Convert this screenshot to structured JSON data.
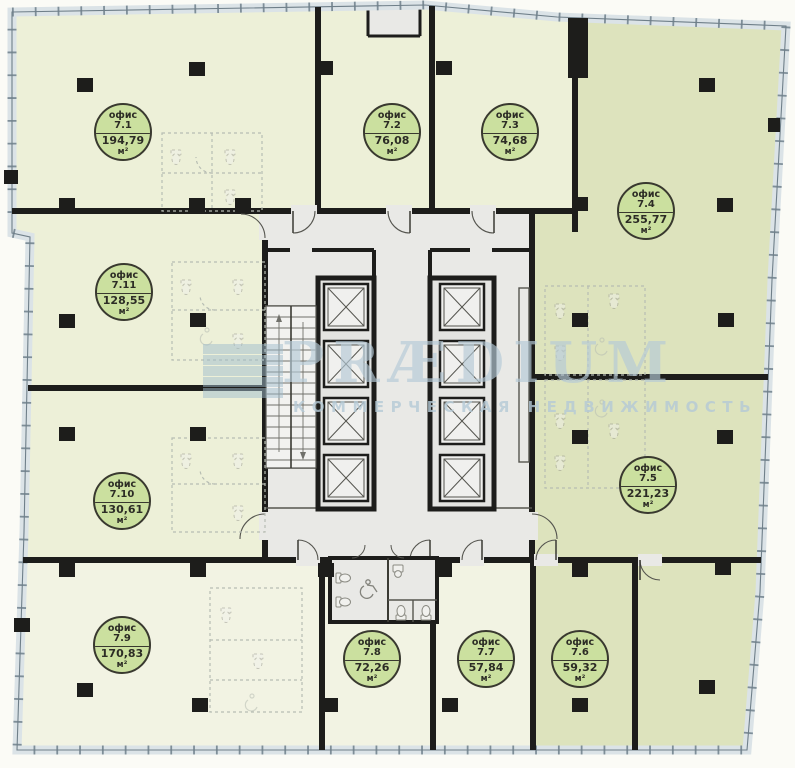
{
  "floor_plan": {
    "watermark": {
      "brand": "PRÆDIUM",
      "tagline": "КОММЕРЧЕСКАЯ НЕДВИЖИМОСТЬ"
    },
    "unit_label": "офис",
    "area_unit": "м²",
    "offices": [
      {
        "id": "7.1",
        "area": "194,79"
      },
      {
        "id": "7.2",
        "area": "76,08"
      },
      {
        "id": "7.3",
        "area": "74,68"
      },
      {
        "id": "7.4",
        "area": "255,77"
      },
      {
        "id": "7.5",
        "area": "221,23"
      },
      {
        "id": "7.6",
        "area": "59,32"
      },
      {
        "id": "7.7",
        "area": "57,84"
      },
      {
        "id": "7.8",
        "area": "72,26"
      },
      {
        "id": "7.9",
        "area": "170,83"
      },
      {
        "id": "7.10",
        "area": "130,61"
      },
      {
        "id": "7.11",
        "area": "128,55"
      }
    ],
    "colors": {
      "badge_fill": "#cbe09f",
      "room_pale_green": "#edf0d8",
      "room_cream": "#f2f3e3",
      "room_olive": "#dde3bd",
      "core_gray": "#e9e9e6",
      "wall_black": "#1d1d1b",
      "watermark_blue": "#b5cad7",
      "window_band": "#dbe3e7"
    },
    "icons": {
      "elevator-icon": "crossed-box elevator car",
      "stairs-icon": "tread lines with direction arrows",
      "wc-icon": "toilet fixture glyph",
      "wheelchair-icon": "accessible WC symbol",
      "column-icon": "solid black structural column square",
      "door-arc-icon": "door swing quarter arc"
    }
  }
}
